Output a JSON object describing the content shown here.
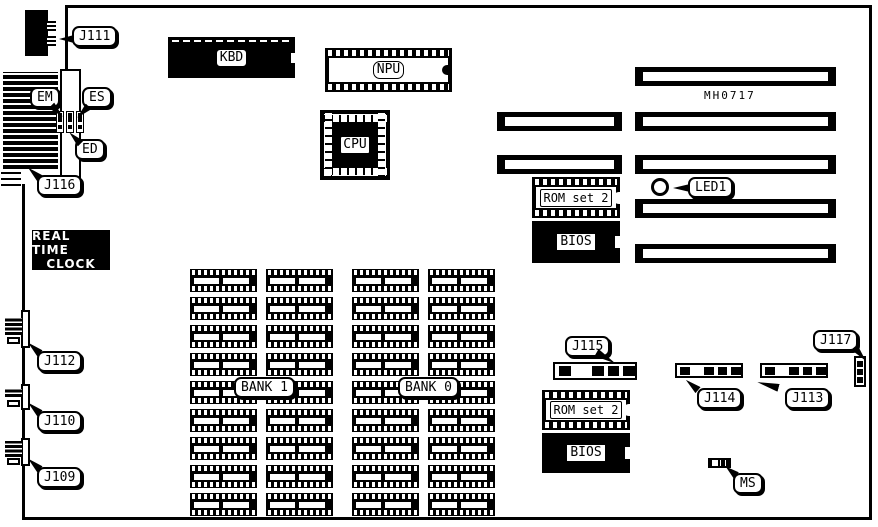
{
  "colors": {
    "ink": "#000000",
    "paper": "#ffffff"
  },
  "board_code": "MH0717",
  "rtc": {
    "line1": "REAL TIME",
    "line2": "CLOCK"
  },
  "chips": {
    "kbd": "KBD",
    "npu": "NPU",
    "cpu": "CPU",
    "rom_set_2_top": "ROM set 2",
    "bios_top": "BIOS",
    "rom_set_2_bottom": "ROM set 2",
    "bios_bottom": "BIOS"
  },
  "banks": {
    "bank1": {
      "label": "BANK 1",
      "rows": 9,
      "cols": 2
    },
    "bank0": {
      "label": "BANK 0",
      "rows": 9,
      "cols": 2
    }
  },
  "slots": {
    "left_column_count": 2,
    "right_column_count": 5
  },
  "callouts": {
    "j111": "J111",
    "em": "EM",
    "es": "ES",
    "ed": "ED",
    "j116": "J116",
    "j112": "J112",
    "j110": "J110",
    "j109": "J109",
    "j115": "J115",
    "j114": "J114",
    "j113": "J113",
    "j117": "J117",
    "led1": "LED1",
    "ms": "MS"
  }
}
